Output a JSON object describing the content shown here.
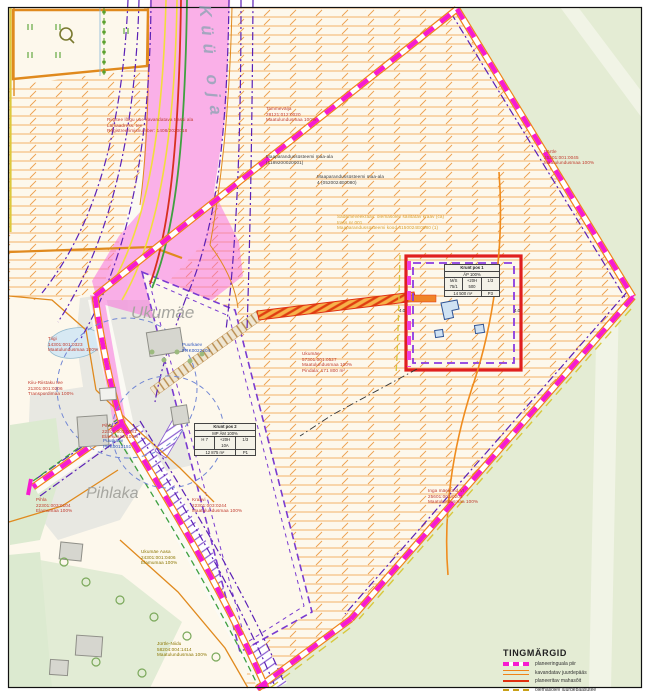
{
  "place_names": {
    "stream": "Küü oja",
    "farm_upper": "Ukumäe",
    "farm_lower": "Pihlaka"
  },
  "labels": [
    {
      "name": "road-restriction-note",
      "lines": [
        "Riigitee lõigu uue kavandatava trassi ala",
        "Lähiaadress: tee",
        "Registreerimisnumber: 1408/2020018"
      ]
    },
    {
      "name": "parcel-tammevalja",
      "lines": [
        "Tammevälja",
        "28121:012:0020",
        "Maatulundusmaa 100%"
      ]
    },
    {
      "name": "drainage-area-1",
      "lines": [
        "Maaparandussüsteemi maa-ala",
        "(1189200020001)"
      ]
    },
    {
      "name": "drainage-area-2",
      "lines": [
        "Maaparandussüsteemi maa-ala",
        "4 (0520024E0080)"
      ]
    },
    {
      "name": "ditch-note",
      "lines": [
        "Sademeveekraav: olemasolev säilitatav kraav (ca)",
        "trass nr 001",
        "Maaparandussüsteemi kood 4150024E0080 (1)"
      ]
    },
    {
      "name": "well-1",
      "lines": [
        "Puurkaev",
        "PRK0022204"
      ]
    },
    {
      "name": "parcel-ukumae",
      "lines": [
        "Ukumäe",
        "57301:001:0527",
        "Maatulundusmaa 100%",
        "Pindala: 171 800 m²"
      ]
    },
    {
      "name": "parcel-partle",
      "lines": [
        "Pärtle",
        "25201:001:0045",
        "Maatulundusmaa 100%"
      ]
    },
    {
      "name": "parcel-tiigi",
      "lines": [
        "Tiigi",
        "14301:001:0323",
        "Maatulundusmaa 100%"
      ]
    },
    {
      "name": "parcel-kiiu-riistaku-tee",
      "lines": [
        "Kiiu-Riistaku tee",
        "21301:001:0206",
        "Transpordimaa 100%"
      ]
    },
    {
      "name": "parcel-pihla-1",
      "lines": [
        "Pihla",
        "22301:003:0081",
        "Elamumaa 100%"
      ]
    },
    {
      "name": "well-2",
      "lines": [
        "Puurkaev",
        "PRK0013151"
      ]
    },
    {
      "name": "parcel-pihla-2",
      "lines": [
        "Pihla",
        "22301:003:0104",
        "Elamumaa 100%"
      ]
    },
    {
      "name": "parcel-kraavi",
      "lines": [
        "Kraavi",
        "22301:003:0244",
        "Maatulundusmaa 100%"
      ]
    },
    {
      "name": "parcel-ukumae-aasa",
      "lines": [
        "Ukumäe Aasa",
        "24301:001:0406",
        "Elamumaa 100%"
      ]
    },
    {
      "name": "parcel-jurtle-niidu",
      "lines": [
        "Jürtle-Niidu",
        "58204:004:1414",
        "Maatulundusmaa 100%"
      ]
    },
    {
      "name": "parcel-inga",
      "lines": [
        "Inga mäekünd VI",
        "25601:003:0202",
        "Maatulundusmaa 100%"
      ]
    }
  ],
  "tables": {
    "pos1": {
      "title": "Krunt pos 1",
      "usage": "ÄP 100%",
      "cells": [
        "M/S 75/1",
        "+20H 500",
        "1/3",
        "14 500 m²",
        "P3"
      ]
    },
    "pos2": {
      "title": "Krunt pos 2",
      "usage": "MP ÄM 100%",
      "cells": [
        "H 7",
        "+20H 10A",
        "1/3",
        "12 875 m²",
        "P1"
      ]
    }
  },
  "dimensions": {
    "left": "4.0",
    "right": "4.0"
  },
  "legend": {
    "title": "TINGMÄRGID",
    "items": [
      {
        "label": "planeeringuala piir",
        "swatch": "magenta-dashed"
      },
      {
        "label": "kavandatav juurdepääs",
        "swatch": "orange-line"
      },
      {
        "label": "planeeritav mahasõit",
        "swatch": "red-line"
      },
      {
        "label": "olemasolev juurdepääsutee",
        "swatch": "yellow-dashed"
      }
    ]
  },
  "colors": {
    "boundary_magenta": "#f71bd0",
    "boundary_base": "#ef8318",
    "parcel_purple": "#7a3bd0",
    "building_plot_red": "#e01f1f",
    "hatch_orange": "#f3b269",
    "grass_green": "#e4ecd4",
    "corridor_pink": "#f965dc",
    "label_red": "#c0392b",
    "label_olive": "#8b7500",
    "label_blue": "#2a52be"
  }
}
